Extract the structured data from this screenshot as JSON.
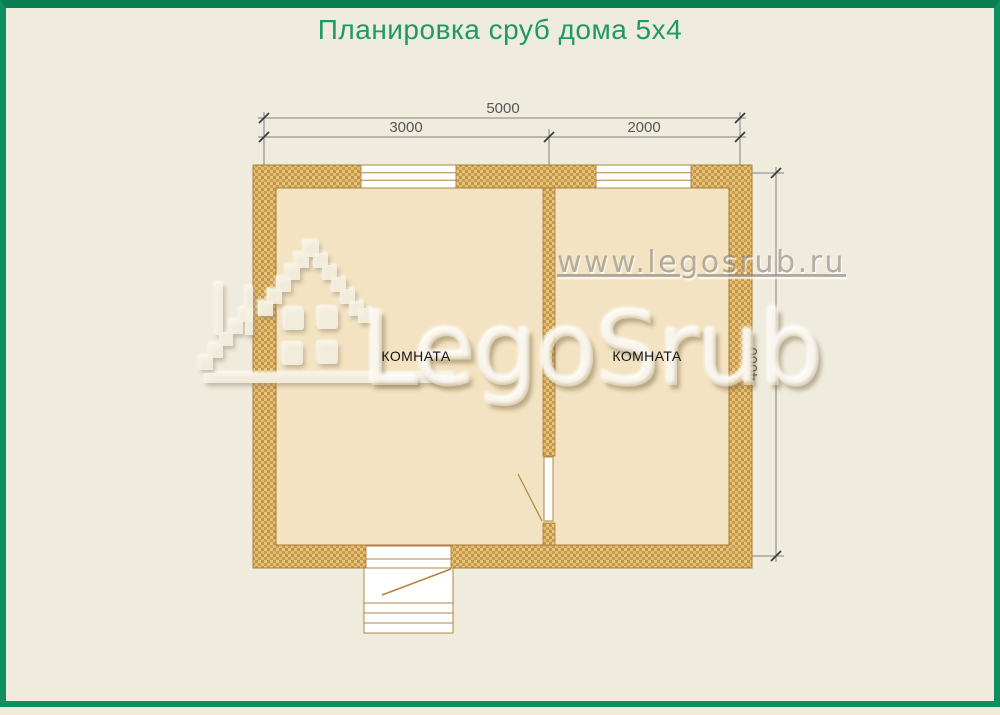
{
  "page": {
    "title": "Планировка сруб дома 5x4",
    "background": "#f0ecdd",
    "border_color": "#0e8f5f",
    "title_color": "#1f9a60"
  },
  "plan": {
    "type": "floor-plan",
    "dimensions": {
      "total_width": "5000",
      "left_room_width": "3000",
      "right_room_width": "2000",
      "height": "4000"
    },
    "rooms": [
      {
        "label": "КОМНАТА"
      },
      {
        "label": "КОМНАТА"
      }
    ],
    "features": [
      "window-left-room",
      "window-right-room",
      "interior-door",
      "entrance-door",
      "porch-steps"
    ],
    "colors": {
      "wall_fill": "#d7a955",
      "wall_outline": "#a87c39",
      "floor": "#f3e3c2",
      "dimension_line": "#7f7f7f",
      "dimension_text": "#565656"
    }
  },
  "watermark": {
    "url": "www.legosrub.ru",
    "brand": "LegoSrub",
    "logo": "pixel-house-icon"
  }
}
